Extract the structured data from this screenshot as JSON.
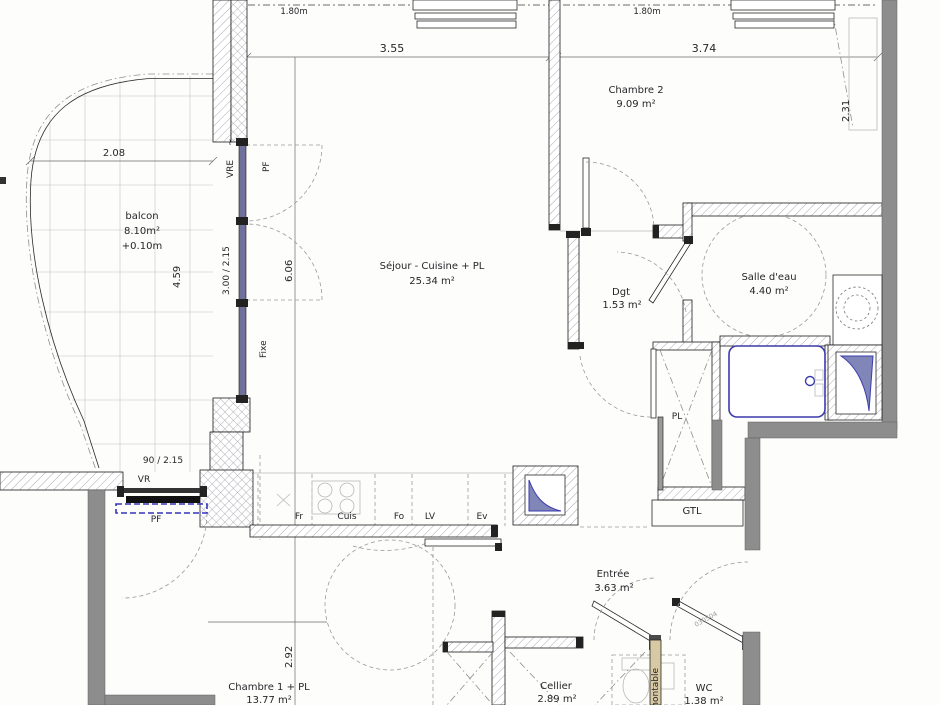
{
  "rooms": {
    "balcon": {
      "name": "balcon",
      "area": "8.10m²",
      "level": "+0.10m"
    },
    "sejour": {
      "name": "Séjour - Cuisine + PL",
      "area": "25.34 m²"
    },
    "chambre2": {
      "name": "Chambre 2",
      "area": "9.09 m²"
    },
    "salle_eau": {
      "name": "Salle d'eau",
      "area": "4.40 m²"
    },
    "dgt": {
      "name": "Dgt",
      "area": "1.53 m²"
    },
    "entree": {
      "name": "Entrée",
      "area": "3.63 m²"
    },
    "cellier": {
      "name": "Cellier",
      "area": "2.89 m²"
    },
    "chambre1": {
      "name": "Chambre 1 + PL",
      "area": "13.77 m²"
    },
    "wc": {
      "name": "WC",
      "area": "1.38 m²"
    }
  },
  "closets": {
    "pl": "PL",
    "gtl": "GTL"
  },
  "dimensions": {
    "d355": "3.55",
    "d374": "3.74",
    "d180_left": "1.80m",
    "d180_right": "1.80m",
    "d231": "2.31",
    "d208": "2.08",
    "d459": "4.59",
    "d300_215": "3.00 / 2.15",
    "d606": "6.06",
    "d90_215": "90 / 2.15",
    "d292": "2.92"
  },
  "openings": {
    "vre": "VRE",
    "vre_mark": "~",
    "pf_top": "PF",
    "fixe": "Fixe",
    "vr": "VR",
    "pf_bottom": "PF"
  },
  "kitchen": {
    "units": [
      "Fr",
      "Cuis",
      "Fo",
      "LV",
      "Ev"
    ]
  },
  "annotations": {
    "partition": "démontable",
    "door_code": "030504"
  },
  "colors": {
    "wall_concrete": "#8d8d8d",
    "glazing_blue": "#70709c",
    "fixture_blue": "#3a3aae",
    "partition_tan": "#d6c9a3",
    "hatch_line": "#a0a0a8"
  }
}
